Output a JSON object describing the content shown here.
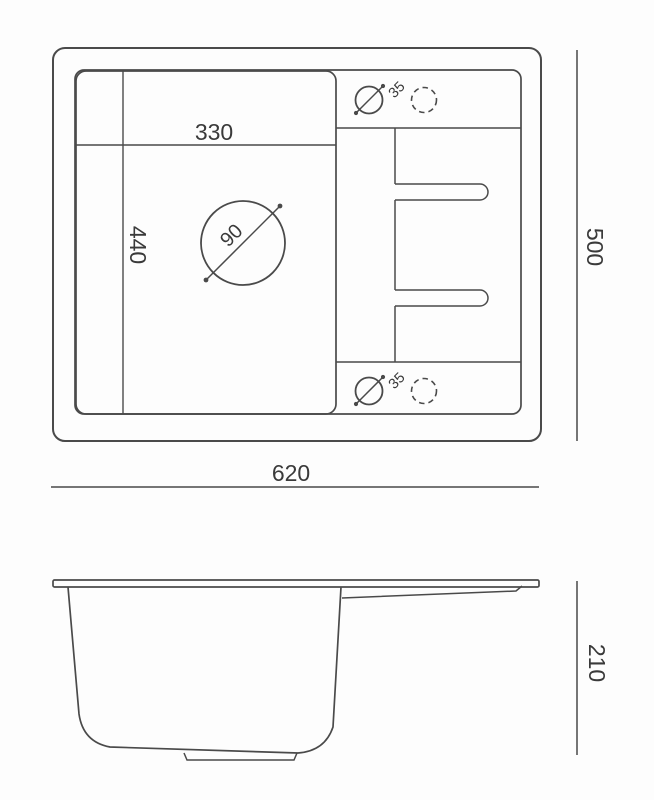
{
  "drawing": {
    "subject": "kitchen sink with drainboard - technical dimension drawing, top view and side view",
    "colors": {
      "line": "#4a4a4a",
      "text": "#3a3a3a",
      "background": "#fdfdfd"
    },
    "top_view": {
      "labels": {
        "bowl_width": "330",
        "bowl_depth": "440",
        "drain_diameter": "90",
        "tap_hole_diameter_top": "35",
        "tap_hole_diameter_bottom": "35",
        "overall_width": "620",
        "overall_depth": "500"
      }
    },
    "side_view": {
      "labels": {
        "height": "210"
      }
    }
  }
}
